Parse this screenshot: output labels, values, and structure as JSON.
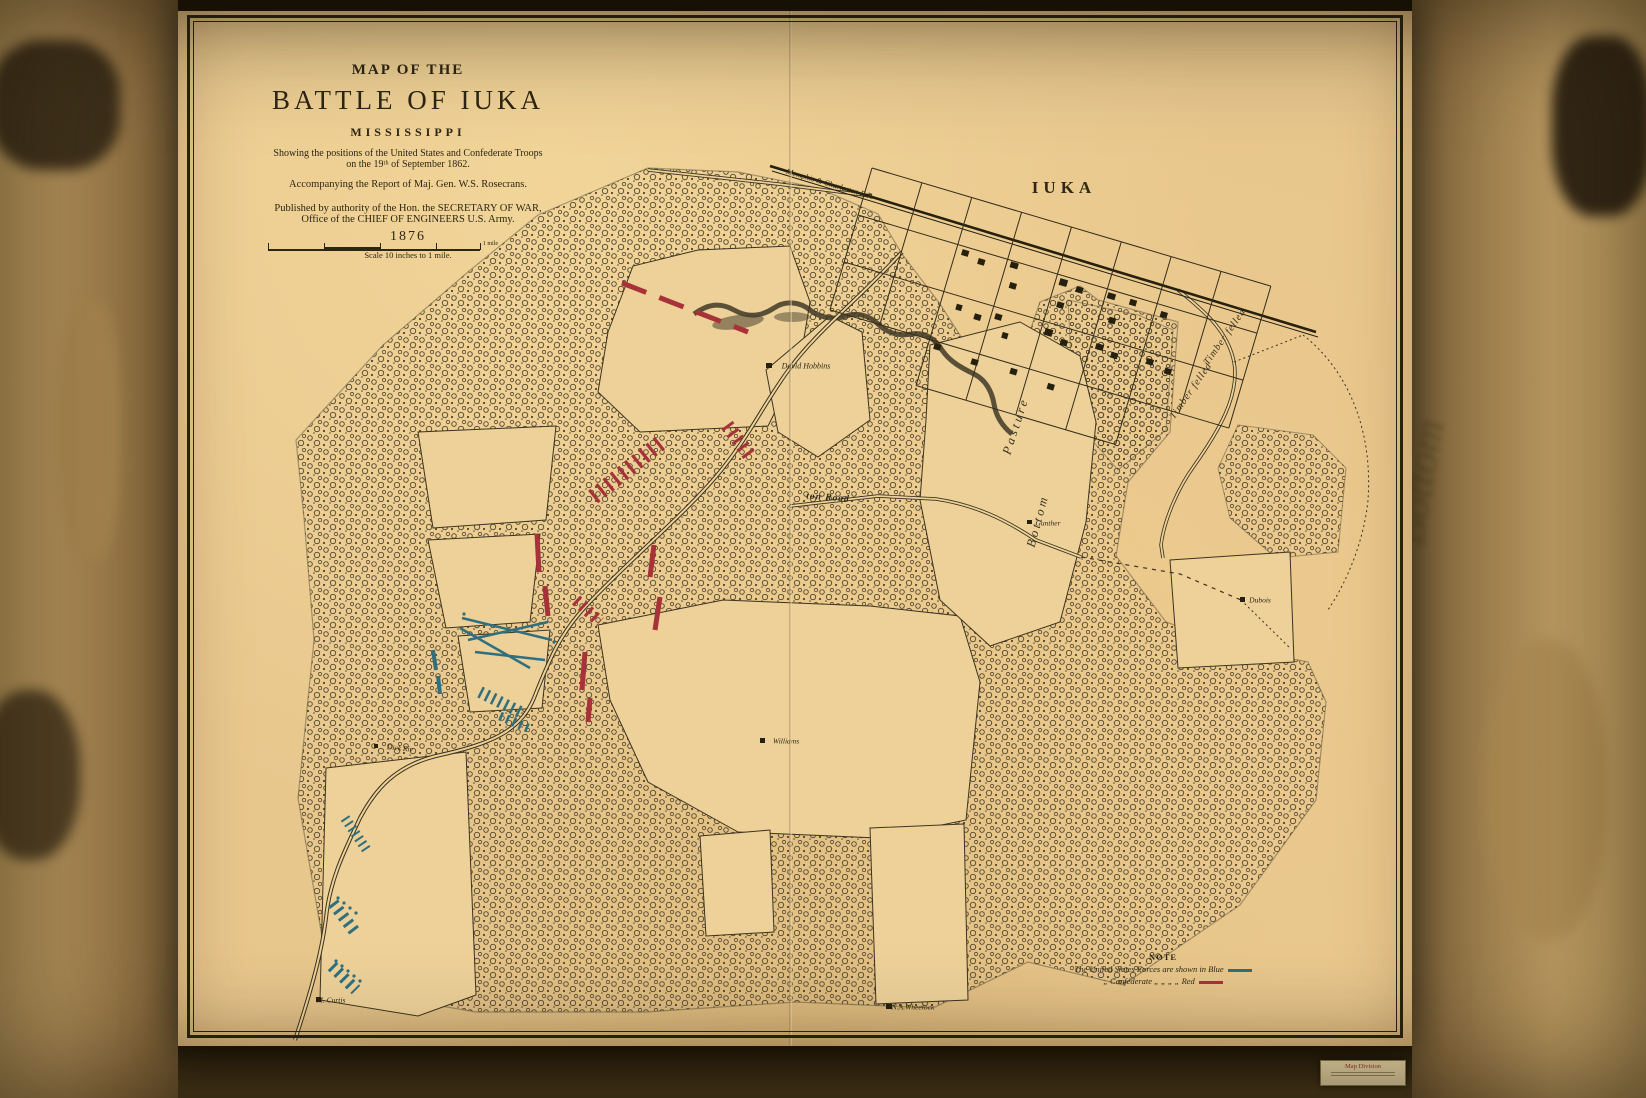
{
  "colors": {
    "paper": "#e8c78d",
    "field": "#edd199",
    "ink": "#332d1a",
    "union_blue": "#2f6f7e",
    "confederate_red": "#a8323a"
  },
  "background": {
    "blurred_word": "Bottom"
  },
  "title_block": {
    "line1": "MAP OF THE",
    "line2": "BATTLE OF IUKA",
    "line3": "MISSISSIPPI",
    "line4": "Showing the positions of the United States and Confederate Troops",
    "line5": "on the 19ᵗʰ of September 1862.",
    "line6": "Accompanying the Report of Maj. Gen. W.S. Rosecrans.",
    "line7": "Published by authority of the Hon. the SECRETARY OF WAR,",
    "line8": "Office of the CHIEF OF ENGINEERS U.S. Army.",
    "line9": "1876",
    "scale_text": "Scale 10 inches to 1 mile.",
    "scale_right_label": "1 mile"
  },
  "note": {
    "heading": "NOTE",
    "line1": "The United States Forces are shown in Blue",
    "line2": "„ Confederate „ „ „ „ Red"
  },
  "sticker": {
    "line1": "Map Division"
  },
  "map_labels": [
    {
      "id": "iuka",
      "text": "IUKA",
      "x": 886,
      "y": 188,
      "rot": 0,
      "cls": "town"
    },
    {
      "id": "railroad",
      "text": "Memphis & Charleston R.R.",
      "x": 652,
      "y": 184,
      "rot": 16.5,
      "cls": "tiny-italic"
    },
    {
      "id": "david-hobbins",
      "text": "David Hobbins",
      "x": 628,
      "y": 366,
      "rot": 0,
      "cls": "tiny-italic"
    },
    {
      "id": "pasture",
      "text": "Pasture",
      "x": 838,
      "y": 426,
      "rot": -72,
      "cls": "terrain"
    },
    {
      "id": "bottom",
      "text": "Bottom",
      "x": 860,
      "y": 521,
      "rot": -75,
      "cls": "terrain"
    },
    {
      "id": "timber-felled-1",
      "text": "Timber felled",
      "x": 1013,
      "y": 391,
      "rot": -55,
      "cls": "terrain-sm"
    },
    {
      "id": "timber-felled-2",
      "text": "Timber felled",
      "x": 1047,
      "y": 337,
      "rot": -55,
      "cls": "terrain-sm"
    },
    {
      "id": "ton-road",
      "text": "ton Road",
      "x": 650,
      "y": 498,
      "rot": 4,
      "cls": "road"
    },
    {
      "id": "gunther",
      "text": "Gunther",
      "x": 870,
      "y": 523,
      "rot": 0,
      "cls": "micro"
    },
    {
      "id": "dubois",
      "text": "Dubois",
      "x": 1082,
      "y": 600,
      "rot": 0,
      "cls": "micro"
    },
    {
      "id": "williams",
      "text": "Williams",
      "x": 608,
      "y": 741,
      "rot": 0,
      "cls": "micro"
    },
    {
      "id": "dick-riv",
      "text": "Dick Riv",
      "x": 222,
      "y": 748,
      "rot": 6,
      "cls": "micro"
    },
    {
      "id": "m-curtis",
      "text": "M. Curtis",
      "x": 153,
      "y": 1000,
      "rot": 0,
      "cls": "micro"
    },
    {
      "id": "wheelock",
      "text": "N.A.Wheelock",
      "x": 735,
      "y": 1007,
      "rot": 0,
      "cls": "micro"
    }
  ]
}
